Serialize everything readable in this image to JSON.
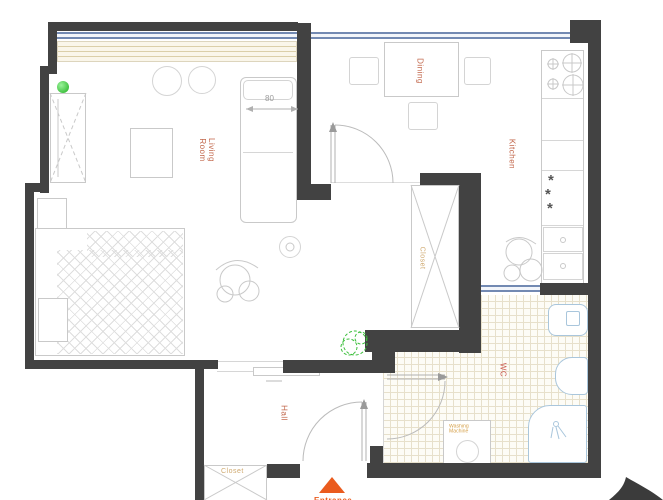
{
  "title": "Apartment floor plan",
  "colors": {
    "wall": "#424242",
    "window_blue": "#7289b2",
    "room_label_orange": "#c2674b",
    "closet_label_tan": "#cfa96f",
    "tile_line": "#e7e0cb",
    "fixture_blue": "#a9c6dc",
    "accent_green": "#1faf1f",
    "entrance_orange": "#ea5b1e"
  },
  "rooms": {
    "living": {
      "line1": "Living",
      "line2": "Room"
    },
    "dining": {
      "label": "Dining"
    },
    "kitchen": {
      "label": "Kitchen"
    },
    "wc": {
      "label": "WC"
    },
    "hall": {
      "label": "Hall"
    },
    "closet_tall": {
      "label": "Closet"
    },
    "closet_hall": {
      "label": "Closet"
    }
  },
  "annotations": {
    "sofa_width": "80",
    "washing_machine_line1": "Washing",
    "washing_machine_line2": "Machine",
    "entrance": "Entrance",
    "freezer_stars": [
      "*",
      "*",
      "*"
    ]
  },
  "icons": {
    "door_marker": "green-dot",
    "plants": "green-scribble",
    "north_arrow": "black-swoosh",
    "entrance_marker": "orange-triangle"
  }
}
